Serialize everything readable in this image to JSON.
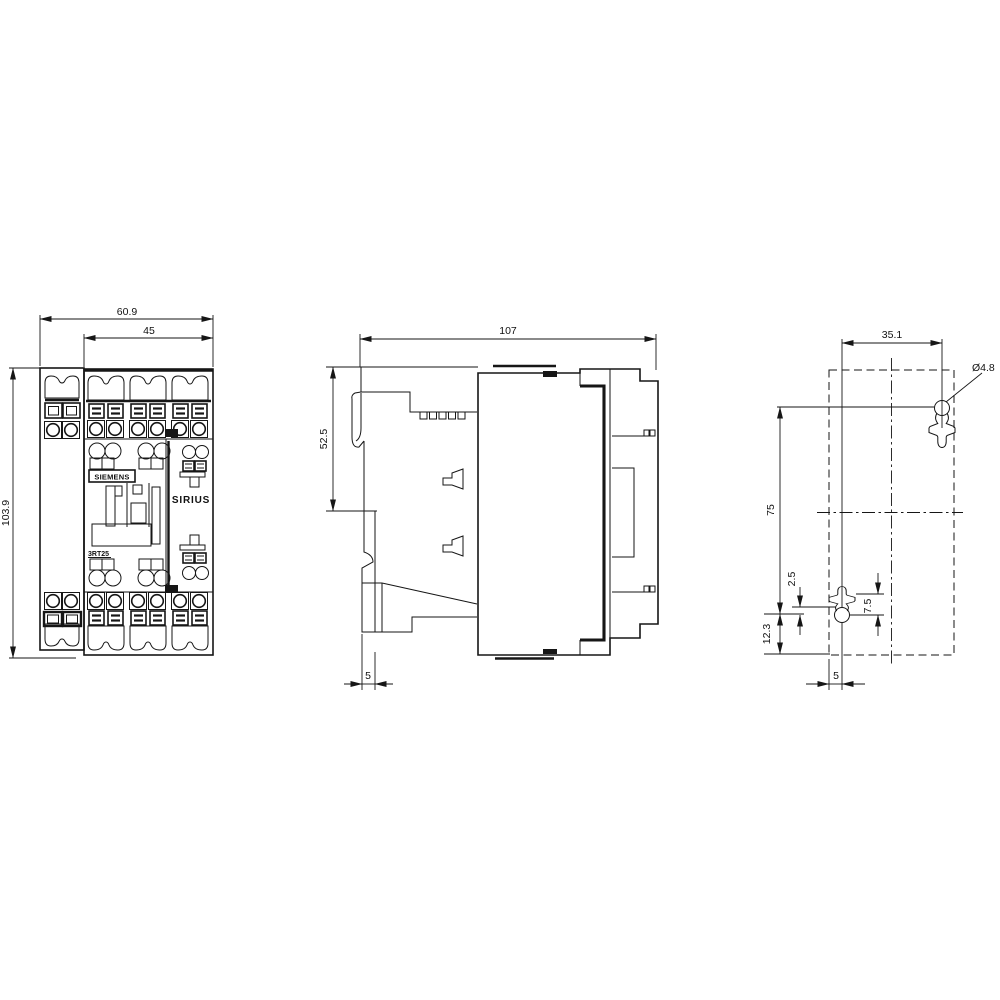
{
  "drawing": {
    "brand": "SIEMENS",
    "product_line": "SIRIUS",
    "model": "3RT25",
    "front_view": {
      "dim_overall_width": "60.9",
      "dim_body_width": "45",
      "dim_height": "103.9"
    },
    "side_view": {
      "dim_depth": "107",
      "dim_upper_depth": "52.5",
      "dim_rail_offset": "5"
    },
    "drilling_plan": {
      "dim_hole_spacing_horizontal": "35.1",
      "dim_hole_diameter": "Ø4.8",
      "dim_hole_spacing_vertical": "75",
      "dim_slot_center_offset": "2.5",
      "dim_slot_length": "7.5",
      "dim_bottom_edge_offset": "12.3",
      "dim_side_edge_offset": "5"
    }
  }
}
